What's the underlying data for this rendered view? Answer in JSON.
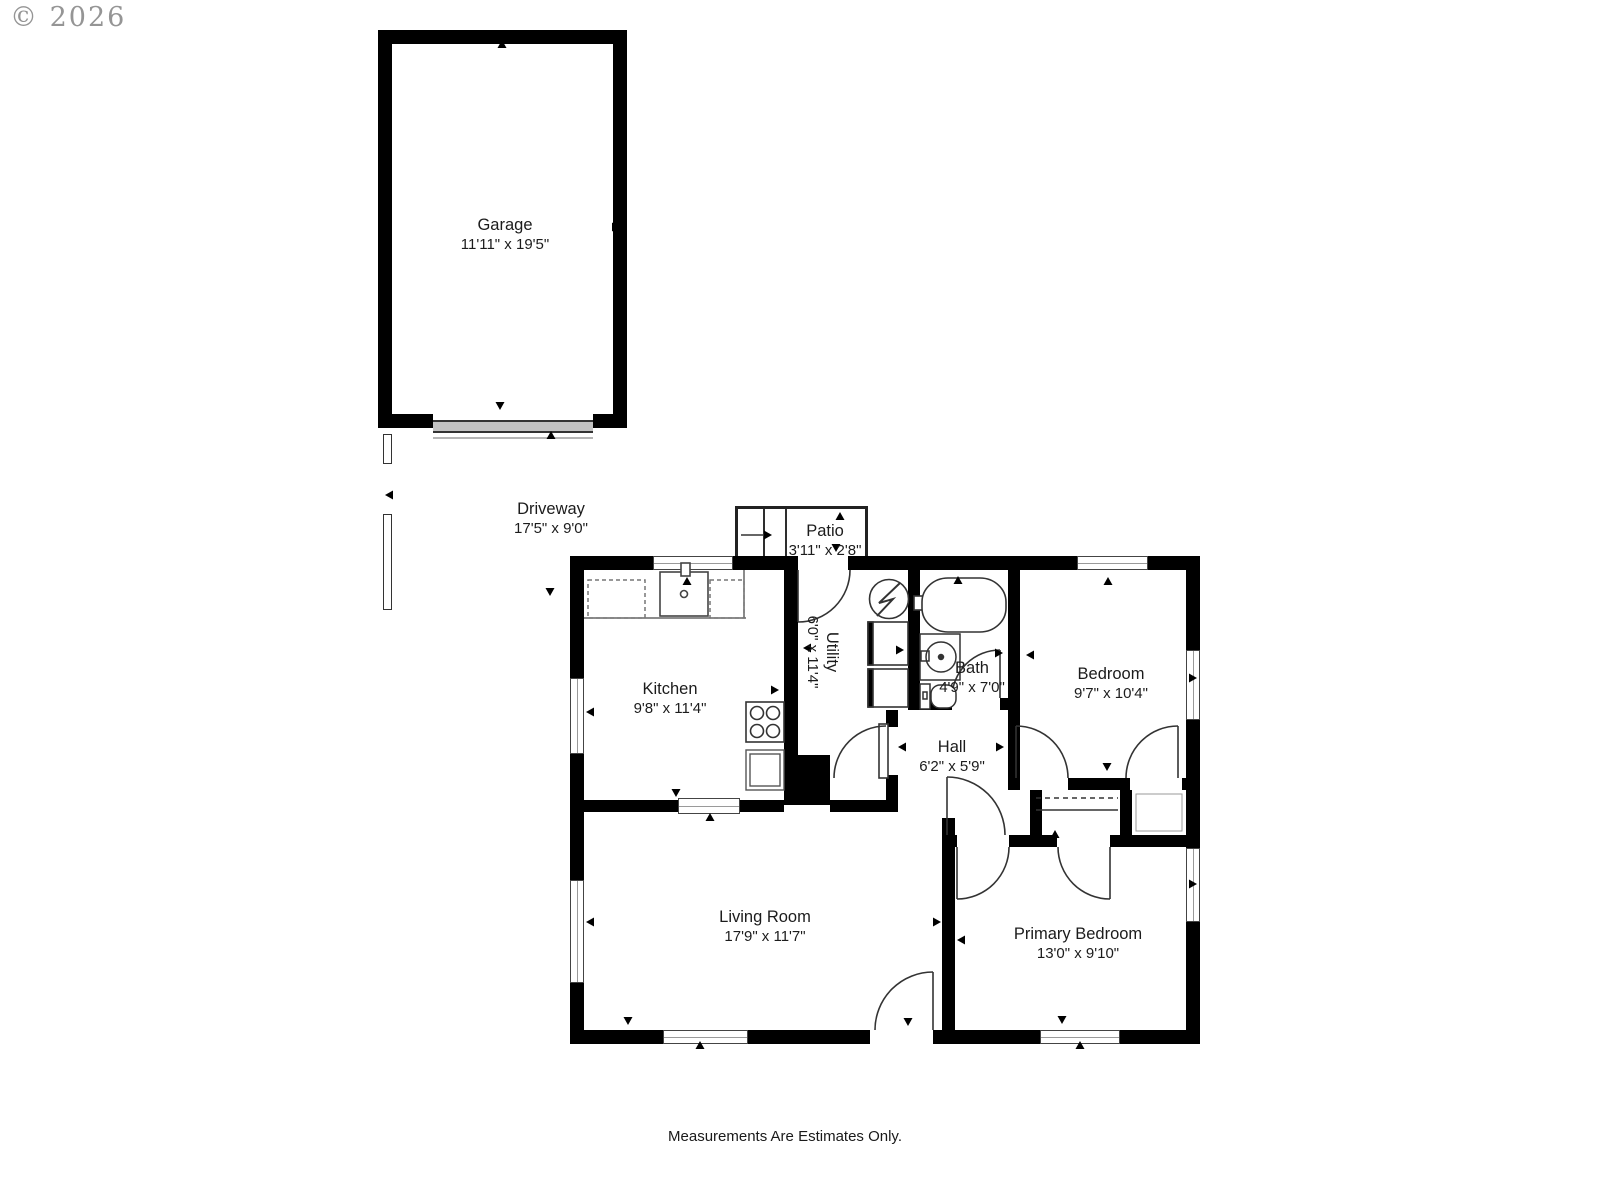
{
  "watermark": {
    "text": "© 2026"
  },
  "footer": {
    "disclaimer": "Measurements Are Estimates Only."
  },
  "colors": {
    "wall": "#000000",
    "line": "#333333",
    "label_text": "#1c1c1c",
    "watermark": "#8a8a8a",
    "garage_door": "#c2c2c2"
  },
  "rooms": {
    "garage": {
      "name": "Garage",
      "dimensions": "11'11\" x 19'5\""
    },
    "driveway": {
      "name": "Driveway",
      "dimensions": "17'5\" x 9'0\""
    },
    "patio": {
      "name": "Patio",
      "dimensions": "3'11\" x 2'8\""
    },
    "kitchen": {
      "name": "Kitchen",
      "dimensions": "9'8\" x 11'4\""
    },
    "utility": {
      "name": "Utility",
      "dimensions": "6'0\" x 11'4\""
    },
    "bath": {
      "name": "Bath",
      "dimensions": "4'9\" x 7'0\""
    },
    "bedroom": {
      "name": "Bedroom",
      "dimensions": "9'7\" x 10'4\""
    },
    "hall": {
      "name": "Hall",
      "dimensions": "6'2\" x 5'9\""
    },
    "living_room": {
      "name": "Living Room",
      "dimensions": "17'9\" x 11'7\""
    },
    "primary_bedroom": {
      "name": "Primary Bedroom",
      "dimensions": "13'0\" x 9'10\""
    }
  },
  "fixture_icons": [
    "range-icon",
    "kitchen-sink-icon",
    "cabinet-icon",
    "water-heater-icon",
    "washer-icon",
    "dryer-icon",
    "bathtub-icon",
    "vanity-sink-icon",
    "toilet-icon",
    "garage-door-icon",
    "steps-icon",
    "door-swing-icon",
    "window-icon",
    "closet-rod-icon",
    "dimension-arrow-icon"
  ]
}
